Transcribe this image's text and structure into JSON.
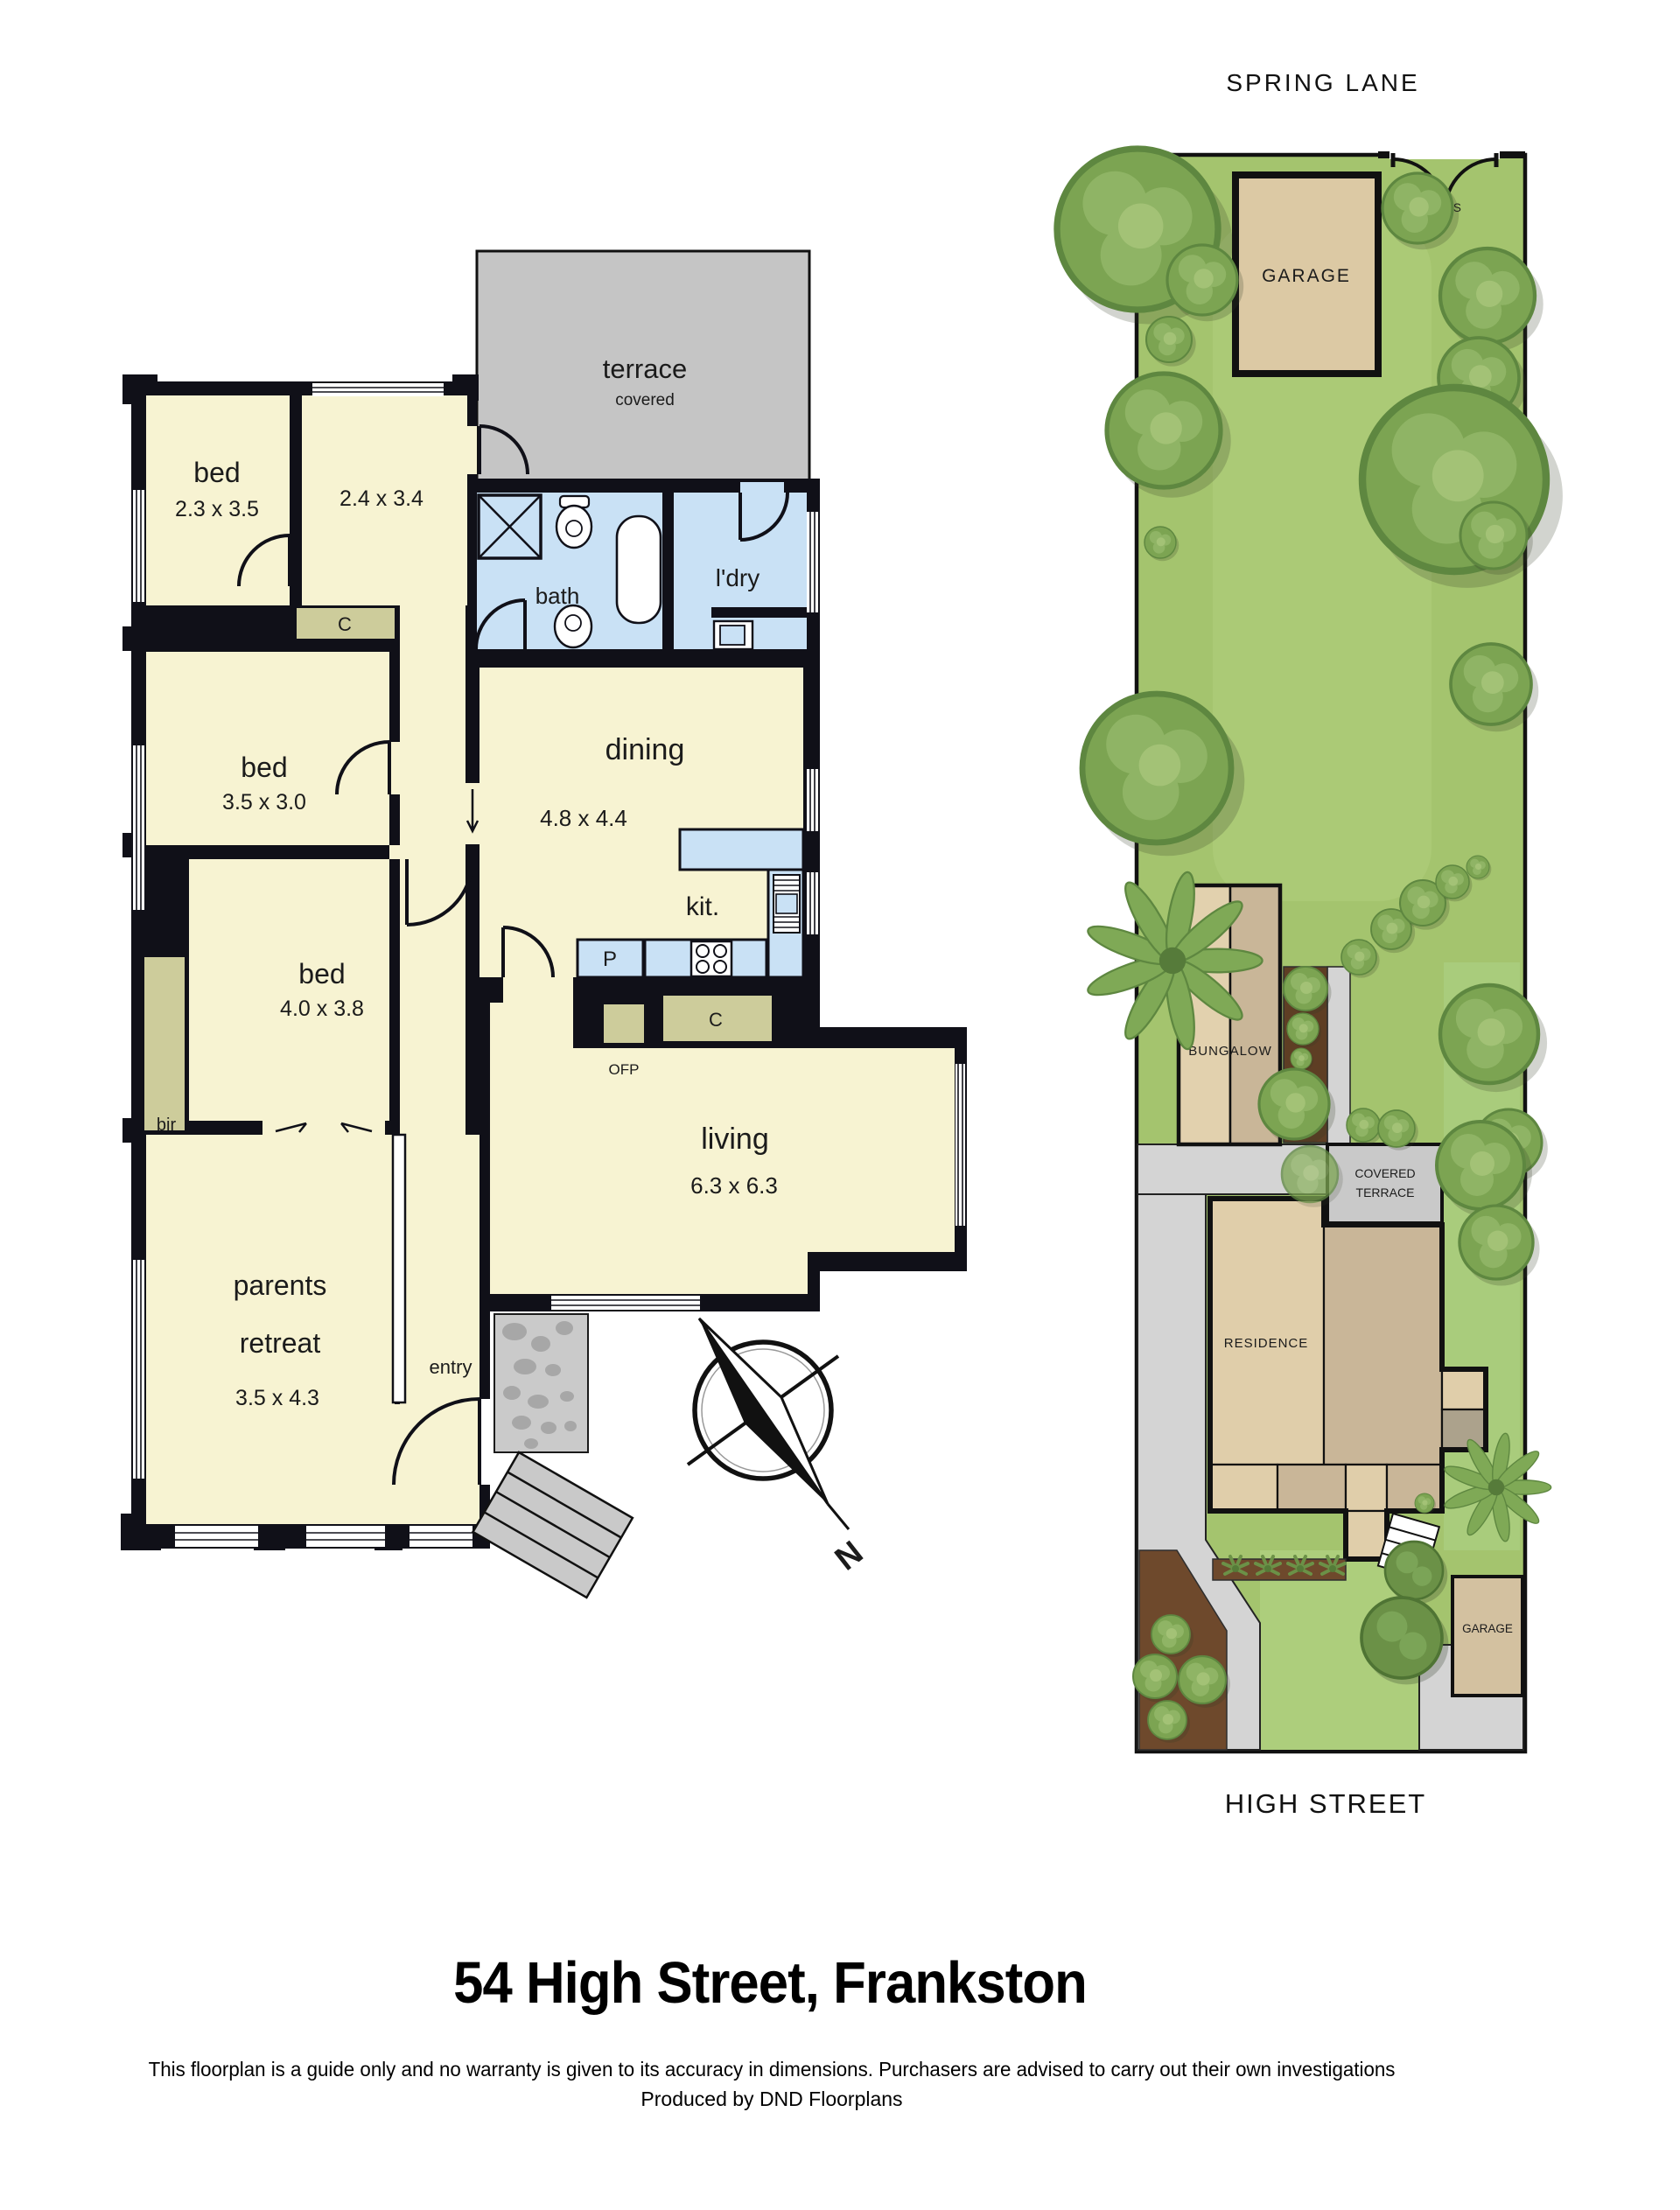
{
  "footer": {
    "title": "54 High Street, Frankston",
    "disclaimer": "This floorplan is a guide only and no warranty is given to  its accuracy in dimensions.  Purchasers are advised to carry out their own investigations",
    "produced_by": "Produced by DND Floorplans"
  },
  "floorplan": {
    "terrace_label": "terrace",
    "terrace_sub": "covered",
    "bed1_label": "bed",
    "bed1_dims": "2.3 x 3.5",
    "room24_dims": "2.4 x 3.4",
    "bath_label": "bath",
    "laundry_label": "l'dry",
    "dining_label": "dining",
    "dining_dims": "4.8 x 4.4",
    "bed2_label": "bed",
    "bed2_dims": "3.5 x 3.0",
    "bed3_label": "bed",
    "bed3_dims": "4.0 x 3.8",
    "bir_label": "bir",
    "kitchen_label": "kit.",
    "pantry_label": "P",
    "closet1_label": "C",
    "closet2_label": "C",
    "ofp_label": "OFP",
    "living_label": "living",
    "living_dims": "6.3 x 6.3",
    "parents_label1": "parents",
    "parents_label2": "retreat",
    "parents_dims": "3.5 x 4.3",
    "entry_label": "entry",
    "north_label": "N"
  },
  "siteplan": {
    "street_top": "SPRING LANE",
    "street_bottom": "HIGH STREET",
    "garage_top_label": "GARAGE",
    "gates_label": "GATES",
    "bungalow_label": "BUNGALOW",
    "covered_terrace_line1": "COVERED",
    "covered_terrace_line2": "TERRACE",
    "residence_label": "RESIDENCE",
    "garage_bottom_label": "GARAGE"
  },
  "colors": {
    "wall_black": "#101018",
    "room_cream": "#F7F3D2",
    "wet_blue": "#C9E1F5",
    "closet_olive": "#CDCC9B",
    "terrace_gray": "#C5C5C5",
    "lot_green": "#A4C46E",
    "lawn_light": "#B2D07E",
    "tree_green": "#7CA452",
    "tree_dark": "#5E8740",
    "building_tan": "#DCC9A4",
    "building_taupe": "#C9B698",
    "garden_brown": "#6E492C",
    "paving_gray": "#D4D4D4"
  }
}
